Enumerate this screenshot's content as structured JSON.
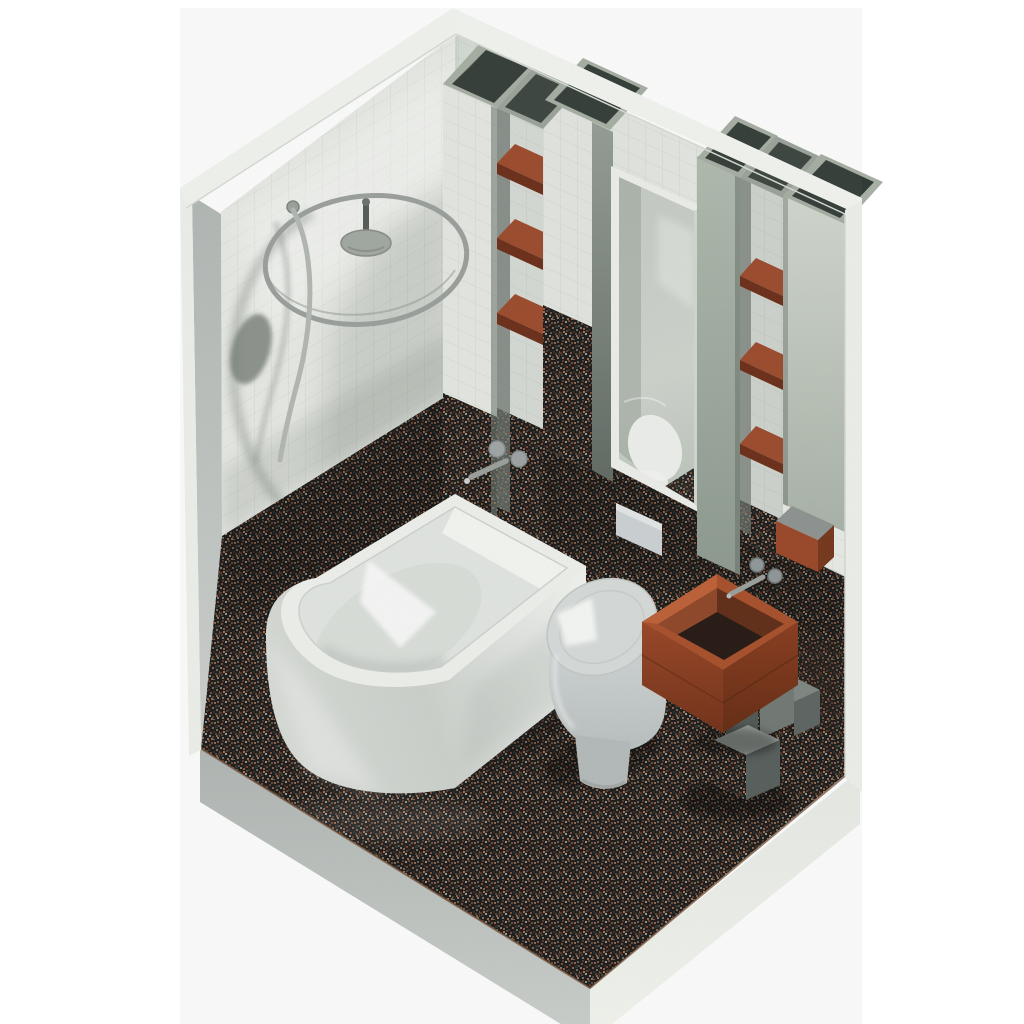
{
  "meta": {
    "title": "Isometric 3D render of a small bathroom with granite floor, white tiled walls, corner bathtub, toilet, copper box sink and circular shower rail",
    "visible_text": "none"
  },
  "scene": {
    "projection": "isometric",
    "room": {
      "type": "bathroom",
      "walls_visible": 2,
      "wall_material": "white square tile",
      "lower_band_material": "dark speckled granite tile",
      "floor_material": "dark speckled granite tile"
    },
    "objects": [
      {
        "name": "corner-bathtub",
        "position": "left corner, round front end"
      },
      {
        "name": "toilet",
        "position": "against right wall below mirror"
      },
      {
        "name": "flush-plate",
        "position": "granite band above toilet"
      },
      {
        "name": "copper-box-sink",
        "position": "on stacked granite block pedestal"
      },
      {
        "name": "stone-block-pedestal",
        "blocks": 3
      },
      {
        "name": "sink-faucet",
        "handles": 2
      },
      {
        "name": "bath-faucet",
        "handles": 2
      },
      {
        "name": "circular-shower-curtain-rail",
        "mount": "ceiling rod and disc"
      },
      {
        "name": "hand-shower-hose"
      },
      {
        "name": "mirror",
        "position": "right wall between pillars"
      },
      {
        "name": "shelf-niche-left",
        "shelves": 3
      },
      {
        "name": "shelf-niche-right",
        "shelves": 3
      },
      {
        "name": "hollow-top-pillars",
        "count": 4
      },
      {
        "name": "rust-box-shelf",
        "position": "lower right wall"
      }
    ]
  },
  "colors": {
    "background": "#ffffff",
    "wall_tile_left": "#e8ebe5",
    "wall_tile_right": "#dfe4de",
    "wall_top_band": "#f4f6f1",
    "outer_edge": "#eff2ec",
    "wall_cut_face": "#bcc2bf",
    "granite_base": "#1b1917",
    "granite_edge_line": "#6e4a2f",
    "slab_left_face": "#b9bfbc",
    "slab_right_face": "#edf0ea",
    "fixture_white": "#f0f2ee",
    "tub_interior": "#e3e7e3",
    "toilet_lid": "#d7dcda",
    "flush_plate": "#cdd2d5",
    "copper_rim": "#a84e28",
    "copper_face_left": "#8f3f21",
    "copper_face_right": "#7d3418",
    "basin_dark": "#241611",
    "shelf_top": "#9c492a",
    "shelf_front": "#6b2c16",
    "rust_box": "#9a4526",
    "pillar_side": "#76807a",
    "mirror_frame": "#eef0ec",
    "metal": "#9aa09c",
    "cap_opening": "#323b36"
  }
}
